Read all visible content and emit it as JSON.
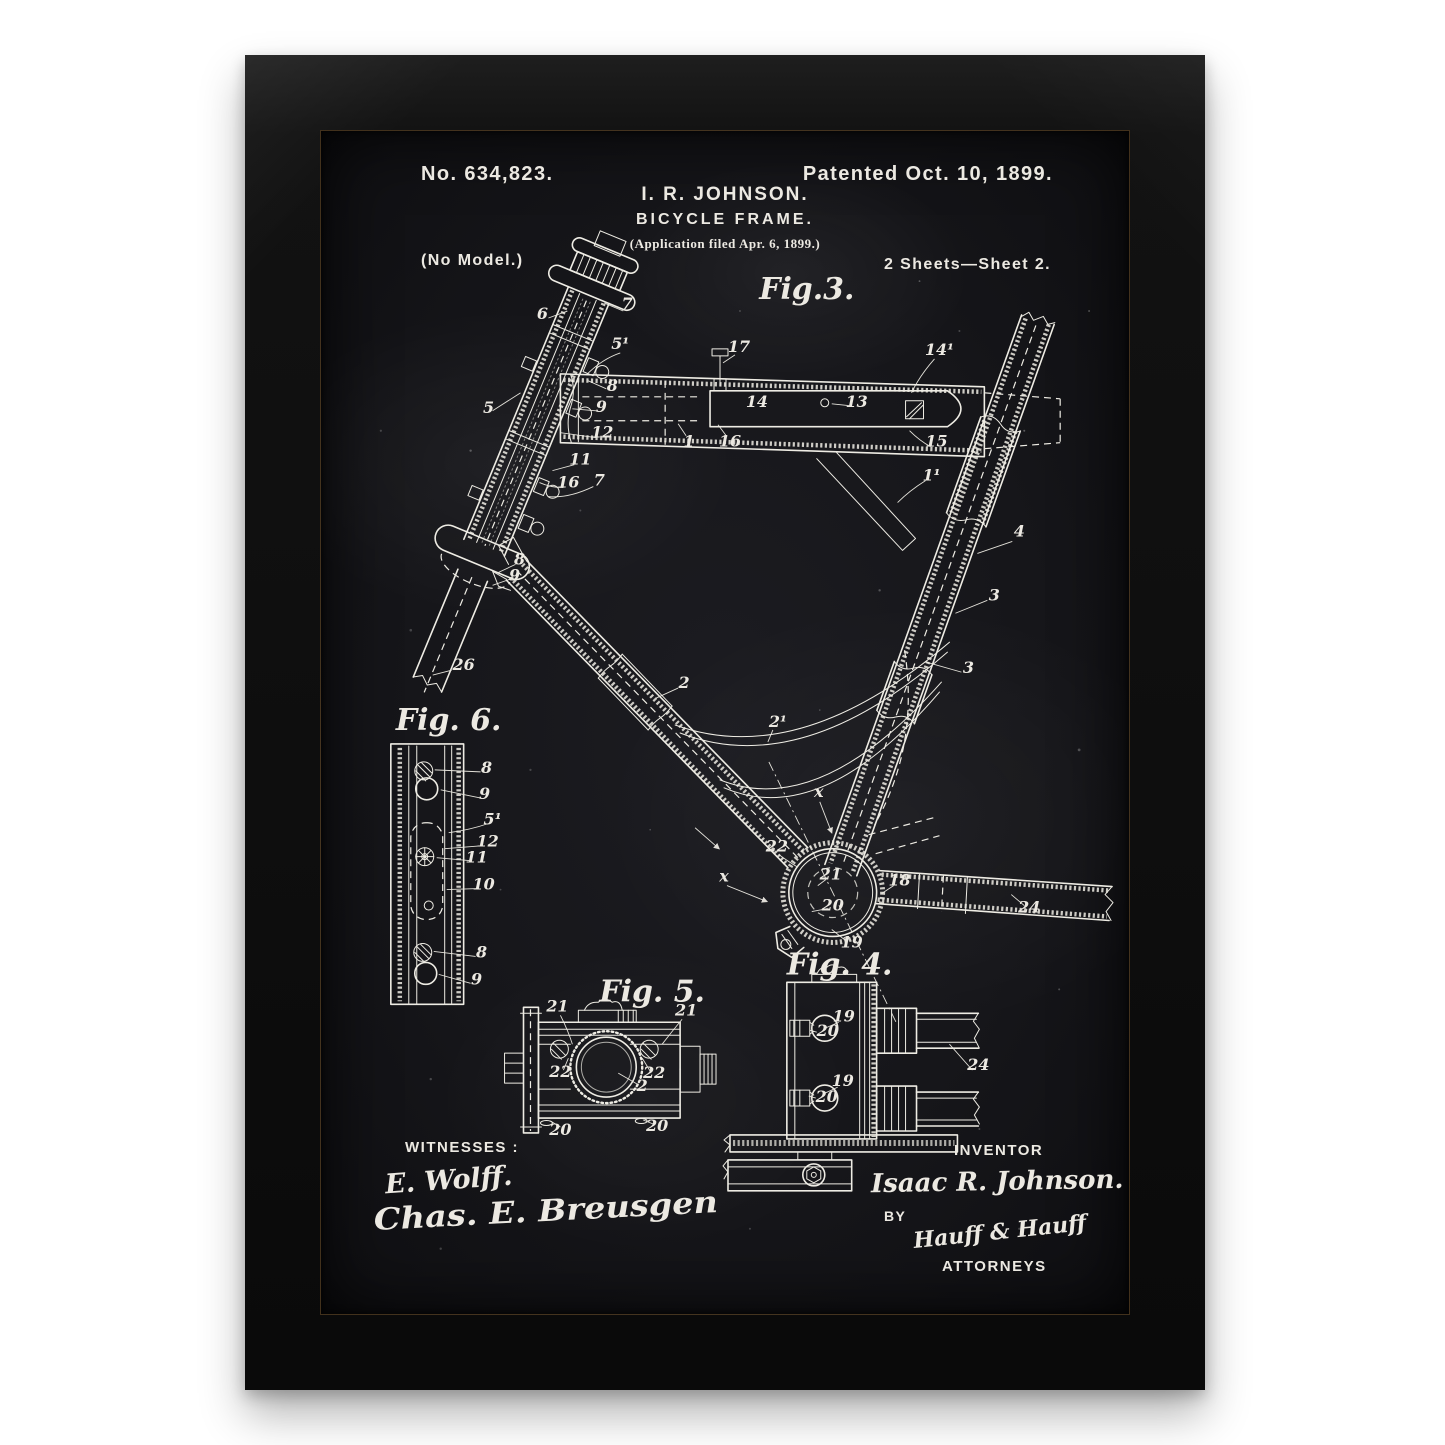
{
  "artwork": {
    "patent_number": "No. 634,823.",
    "patented": "Patented Oct. 10, 1899.",
    "inventor_title": "I. R. JOHNSON.",
    "subject": "BICYCLE FRAME.",
    "application": "(Application filed Apr. 6, 1899.)",
    "no_model": "(No Model.)",
    "sheet": "2 Sheets—Sheet 2.",
    "witnesses_label": "WITNESSES :",
    "witness_signature_1": "E. Wolff.",
    "witness_signature_2": "Chas. E. Breusgen",
    "inventor_label": "INVENTOR",
    "inventor_signature": "Isaac R. Johnson.",
    "by_label": "BY",
    "attorney_signature": "Hauff & Hauff",
    "attorneys_label": "ATTORNEYS",
    "colors": {
      "frame": "#111111",
      "poster_background": "#17171b",
      "ink": "#ece9e2",
      "page": "#ffffff"
    }
  },
  "drawing": {
    "fig_titles": [
      {
        "t": "Fig.3.",
        "x": 487,
        "y": 168
      },
      {
        "t": "Fig. 6.",
        "x": 128,
        "y": 600
      },
      {
        "t": "Fig. 5.",
        "x": 332,
        "y": 872
      },
      {
        "t": "Fig. 4.",
        "x": 520,
        "y": 845
      }
    ],
    "ref_labels": [
      {
        "t": "7",
        "x": 307,
        "y": 178
      },
      {
        "t": "6",
        "x": 222,
        "y": 188
      },
      {
        "t": "5",
        "x": 168,
        "y": 282
      },
      {
        "t": "5¹",
        "x": 300,
        "y": 218
      },
      {
        "t": "8",
        "x": 292,
        "y": 260
      },
      {
        "t": "9",
        "x": 281,
        "y": 281
      },
      {
        "t": "12",
        "x": 282,
        "y": 307
      },
      {
        "t": "11",
        "x": 260,
        "y": 334
      },
      {
        "t": "16",
        "x": 248,
        "y": 357
      },
      {
        "t": "7",
        "x": 279,
        "y": 355
      },
      {
        "t": "8",
        "x": 199,
        "y": 434
      },
      {
        "t": "9",
        "x": 194,
        "y": 450
      },
      {
        "t": "26",
        "x": 143,
        "y": 540
      },
      {
        "t": "17",
        "x": 419,
        "y": 221
      },
      {
        "t": "14",
        "x": 437,
        "y": 276
      },
      {
        "t": "1",
        "x": 369,
        "y": 316
      },
      {
        "t": "16",
        "x": 410,
        "y": 316
      },
      {
        "t": "14¹",
        "x": 620,
        "y": 224
      },
      {
        "t": "13",
        "x": 537,
        "y": 276
      },
      {
        "t": "15",
        "x": 617,
        "y": 316
      },
      {
        "t": "1¹",
        "x": 612,
        "y": 350
      },
      {
        "t": "2",
        "x": 364,
        "y": 558
      },
      {
        "t": "2¹",
        "x": 458,
        "y": 597
      },
      {
        "t": "4",
        "x": 700,
        "y": 406
      },
      {
        "t": "3",
        "x": 675,
        "y": 470
      },
      {
        "t": "3",
        "x": 649,
        "y": 543
      },
      {
        "t": "x",
        "x": 499,
        "y": 667
      },
      {
        "t": "x",
        "x": 404,
        "y": 752
      },
      {
        "t": "22",
        "x": 457,
        "y": 722
      },
      {
        "t": "21",
        "x": 511,
        "y": 750
      },
      {
        "t": "20",
        "x": 513,
        "y": 781
      },
      {
        "t": "19",
        "x": 532,
        "y": 818
      },
      {
        "t": "18",
        "x": 580,
        "y": 756
      },
      {
        "t": "24",
        "x": 710,
        "y": 783
      },
      {
        "t": "8",
        "x": 166,
        "y": 643
      },
      {
        "t": "9",
        "x": 164,
        "y": 669
      },
      {
        "t": "5¹",
        "x": 172,
        "y": 695
      },
      {
        "t": "12",
        "x": 167,
        "y": 717
      },
      {
        "t": "11",
        "x": 156,
        "y": 733
      },
      {
        "t": "10",
        "x": 163,
        "y": 760
      },
      {
        "t": "8",
        "x": 161,
        "y": 828
      },
      {
        "t": "9",
        "x": 156,
        "y": 855
      },
      {
        "t": "21",
        "x": 237,
        "y": 882
      },
      {
        "t": "21",
        "x": 366,
        "y": 886
      },
      {
        "t": "22",
        "x": 240,
        "y": 948
      },
      {
        "t": "22",
        "x": 334,
        "y": 949
      },
      {
        "t": "2",
        "x": 322,
        "y": 962
      },
      {
        "t": "20",
        "x": 240,
        "y": 1006
      },
      {
        "t": "20",
        "x": 337,
        "y": 1002
      },
      {
        "t": "19",
        "x": 524,
        "y": 892
      },
      {
        "t": "20",
        "x": 508,
        "y": 907
      },
      {
        "t": "19",
        "x": 523,
        "y": 957
      },
      {
        "t": "20",
        "x": 507,
        "y": 973
      },
      {
        "t": "24",
        "x": 659,
        "y": 941
      }
    ]
  }
}
